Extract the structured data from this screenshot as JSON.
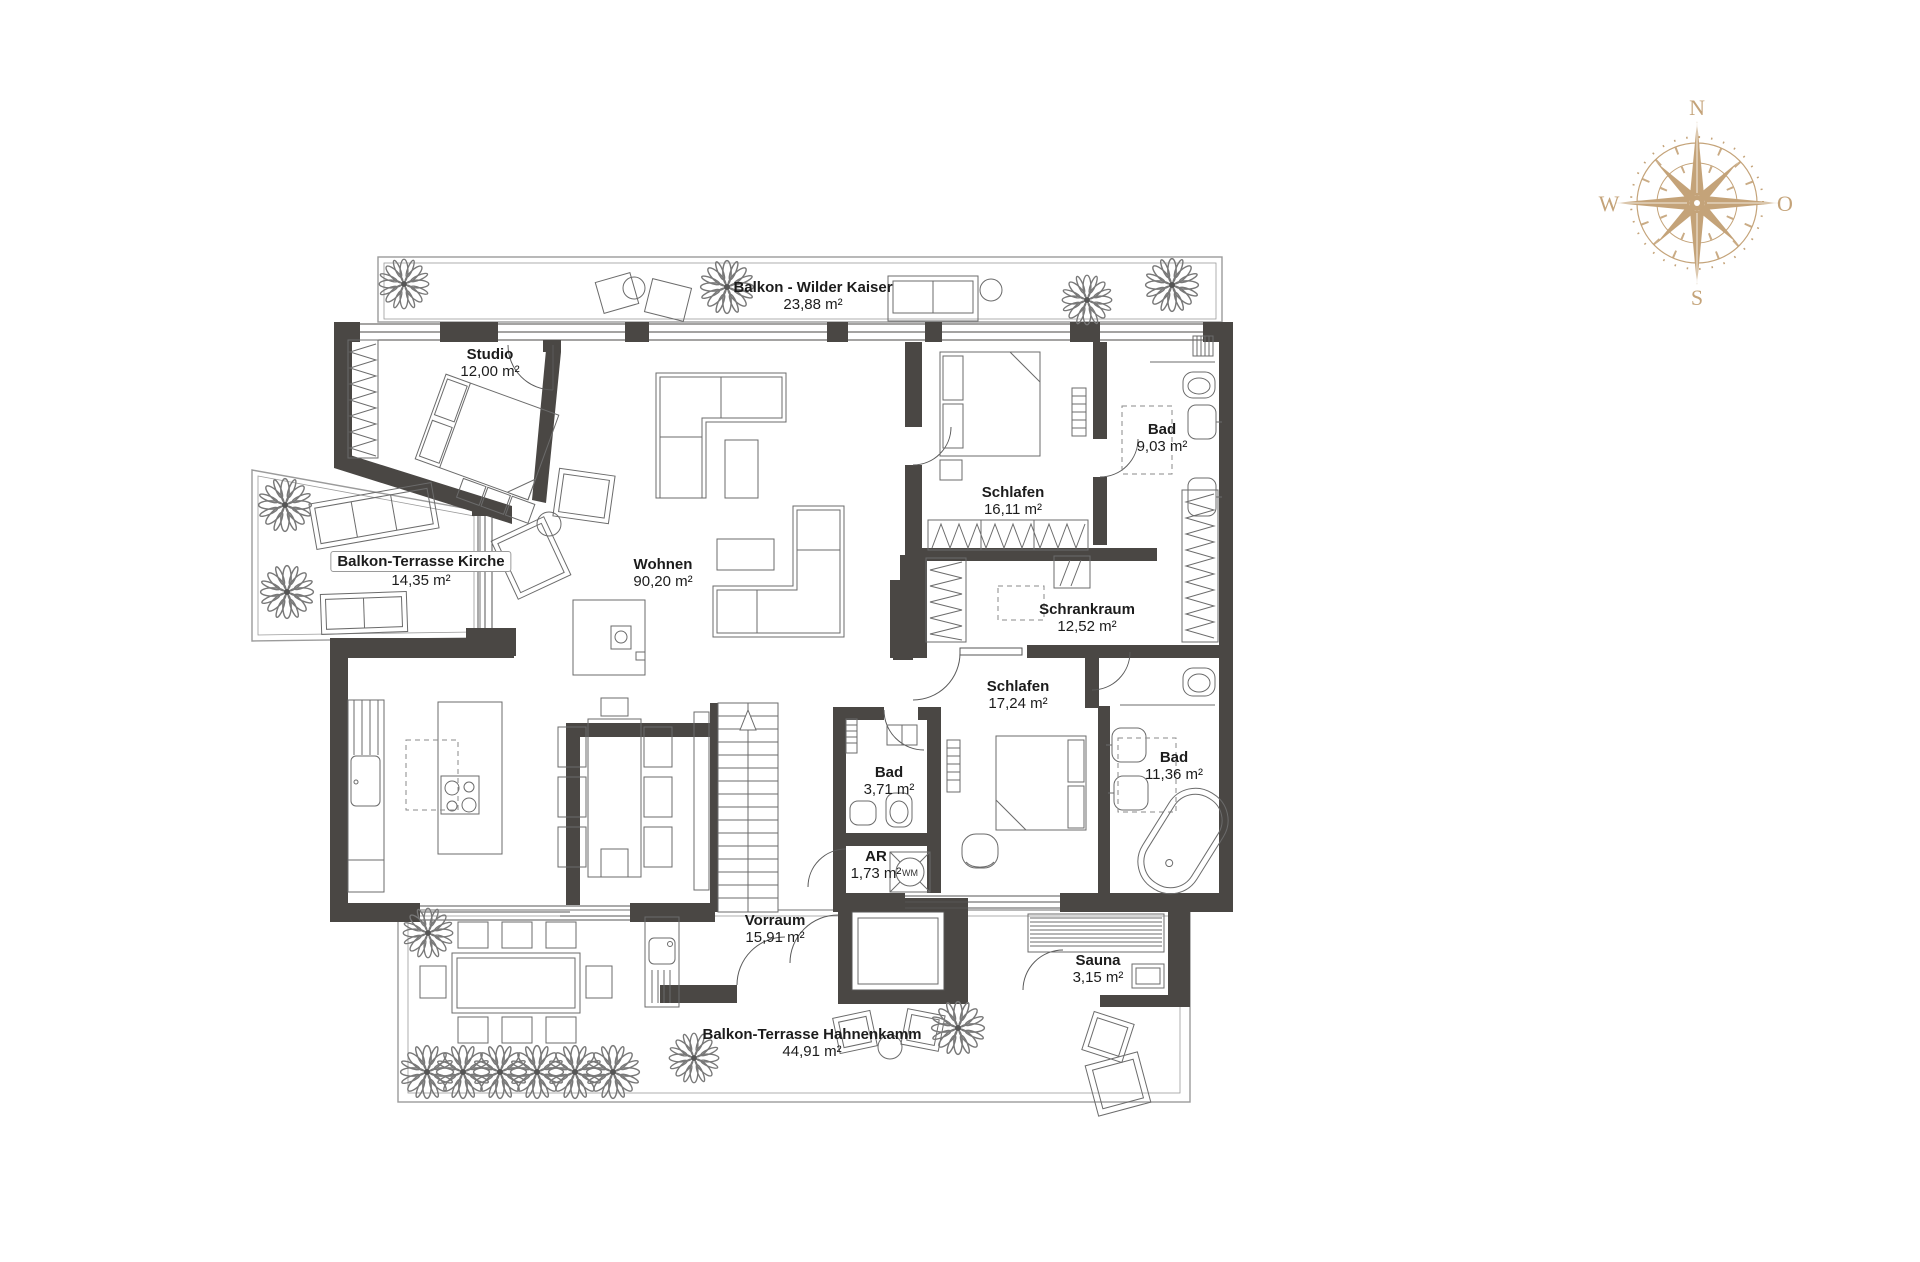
{
  "title": "Apartment floor plan",
  "rooms": [
    {
      "id": "balkon-wilder-kaiser",
      "name": "Balkon - Wilder Kaiser",
      "area": "23,88 m²"
    },
    {
      "id": "studio",
      "name": "Studio",
      "area": "12,00 m²"
    },
    {
      "id": "balkon-terrasse-kirche",
      "name": "Balkon-Terrasse Kirche",
      "area": "14,35 m²"
    },
    {
      "id": "wohnen",
      "name": "Wohnen",
      "area": "90,20 m²"
    },
    {
      "id": "schlafen-1",
      "name": "Schlafen",
      "area": "16,11 m²"
    },
    {
      "id": "bad-1",
      "name": "Bad",
      "area": "9,03 m²"
    },
    {
      "id": "schrankraum",
      "name": "Schrankraum",
      "area": "12,52 m²"
    },
    {
      "id": "schlafen-2",
      "name": "Schlafen",
      "area": "17,24 m²"
    },
    {
      "id": "bad-2",
      "name": "Bad",
      "area": "3,71 m²"
    },
    {
      "id": "ar",
      "name": "AR",
      "area": "1,73 m²"
    },
    {
      "id": "bad-3",
      "name": "Bad",
      "area": "11,36 m²"
    },
    {
      "id": "vorraum",
      "name": "Vorraum",
      "area": "15,91 m²"
    },
    {
      "id": "sauna",
      "name": "Sauna",
      "area": "3,15 m²"
    },
    {
      "id": "balkon-terrasse-hahnenkamm",
      "name": "Balkon-Terrasse Hahnenkamm",
      "area": "44,91 m²"
    }
  ],
  "appliances": {
    "washing_machine": "WM"
  },
  "compass": {
    "north": "N",
    "east": "O",
    "south": "S",
    "west": "W"
  },
  "colors": {
    "wall": "#4a4744",
    "furniture_line": "#6b6b6b",
    "outline": "#9b9b9b",
    "compass": "#c4a379"
  }
}
